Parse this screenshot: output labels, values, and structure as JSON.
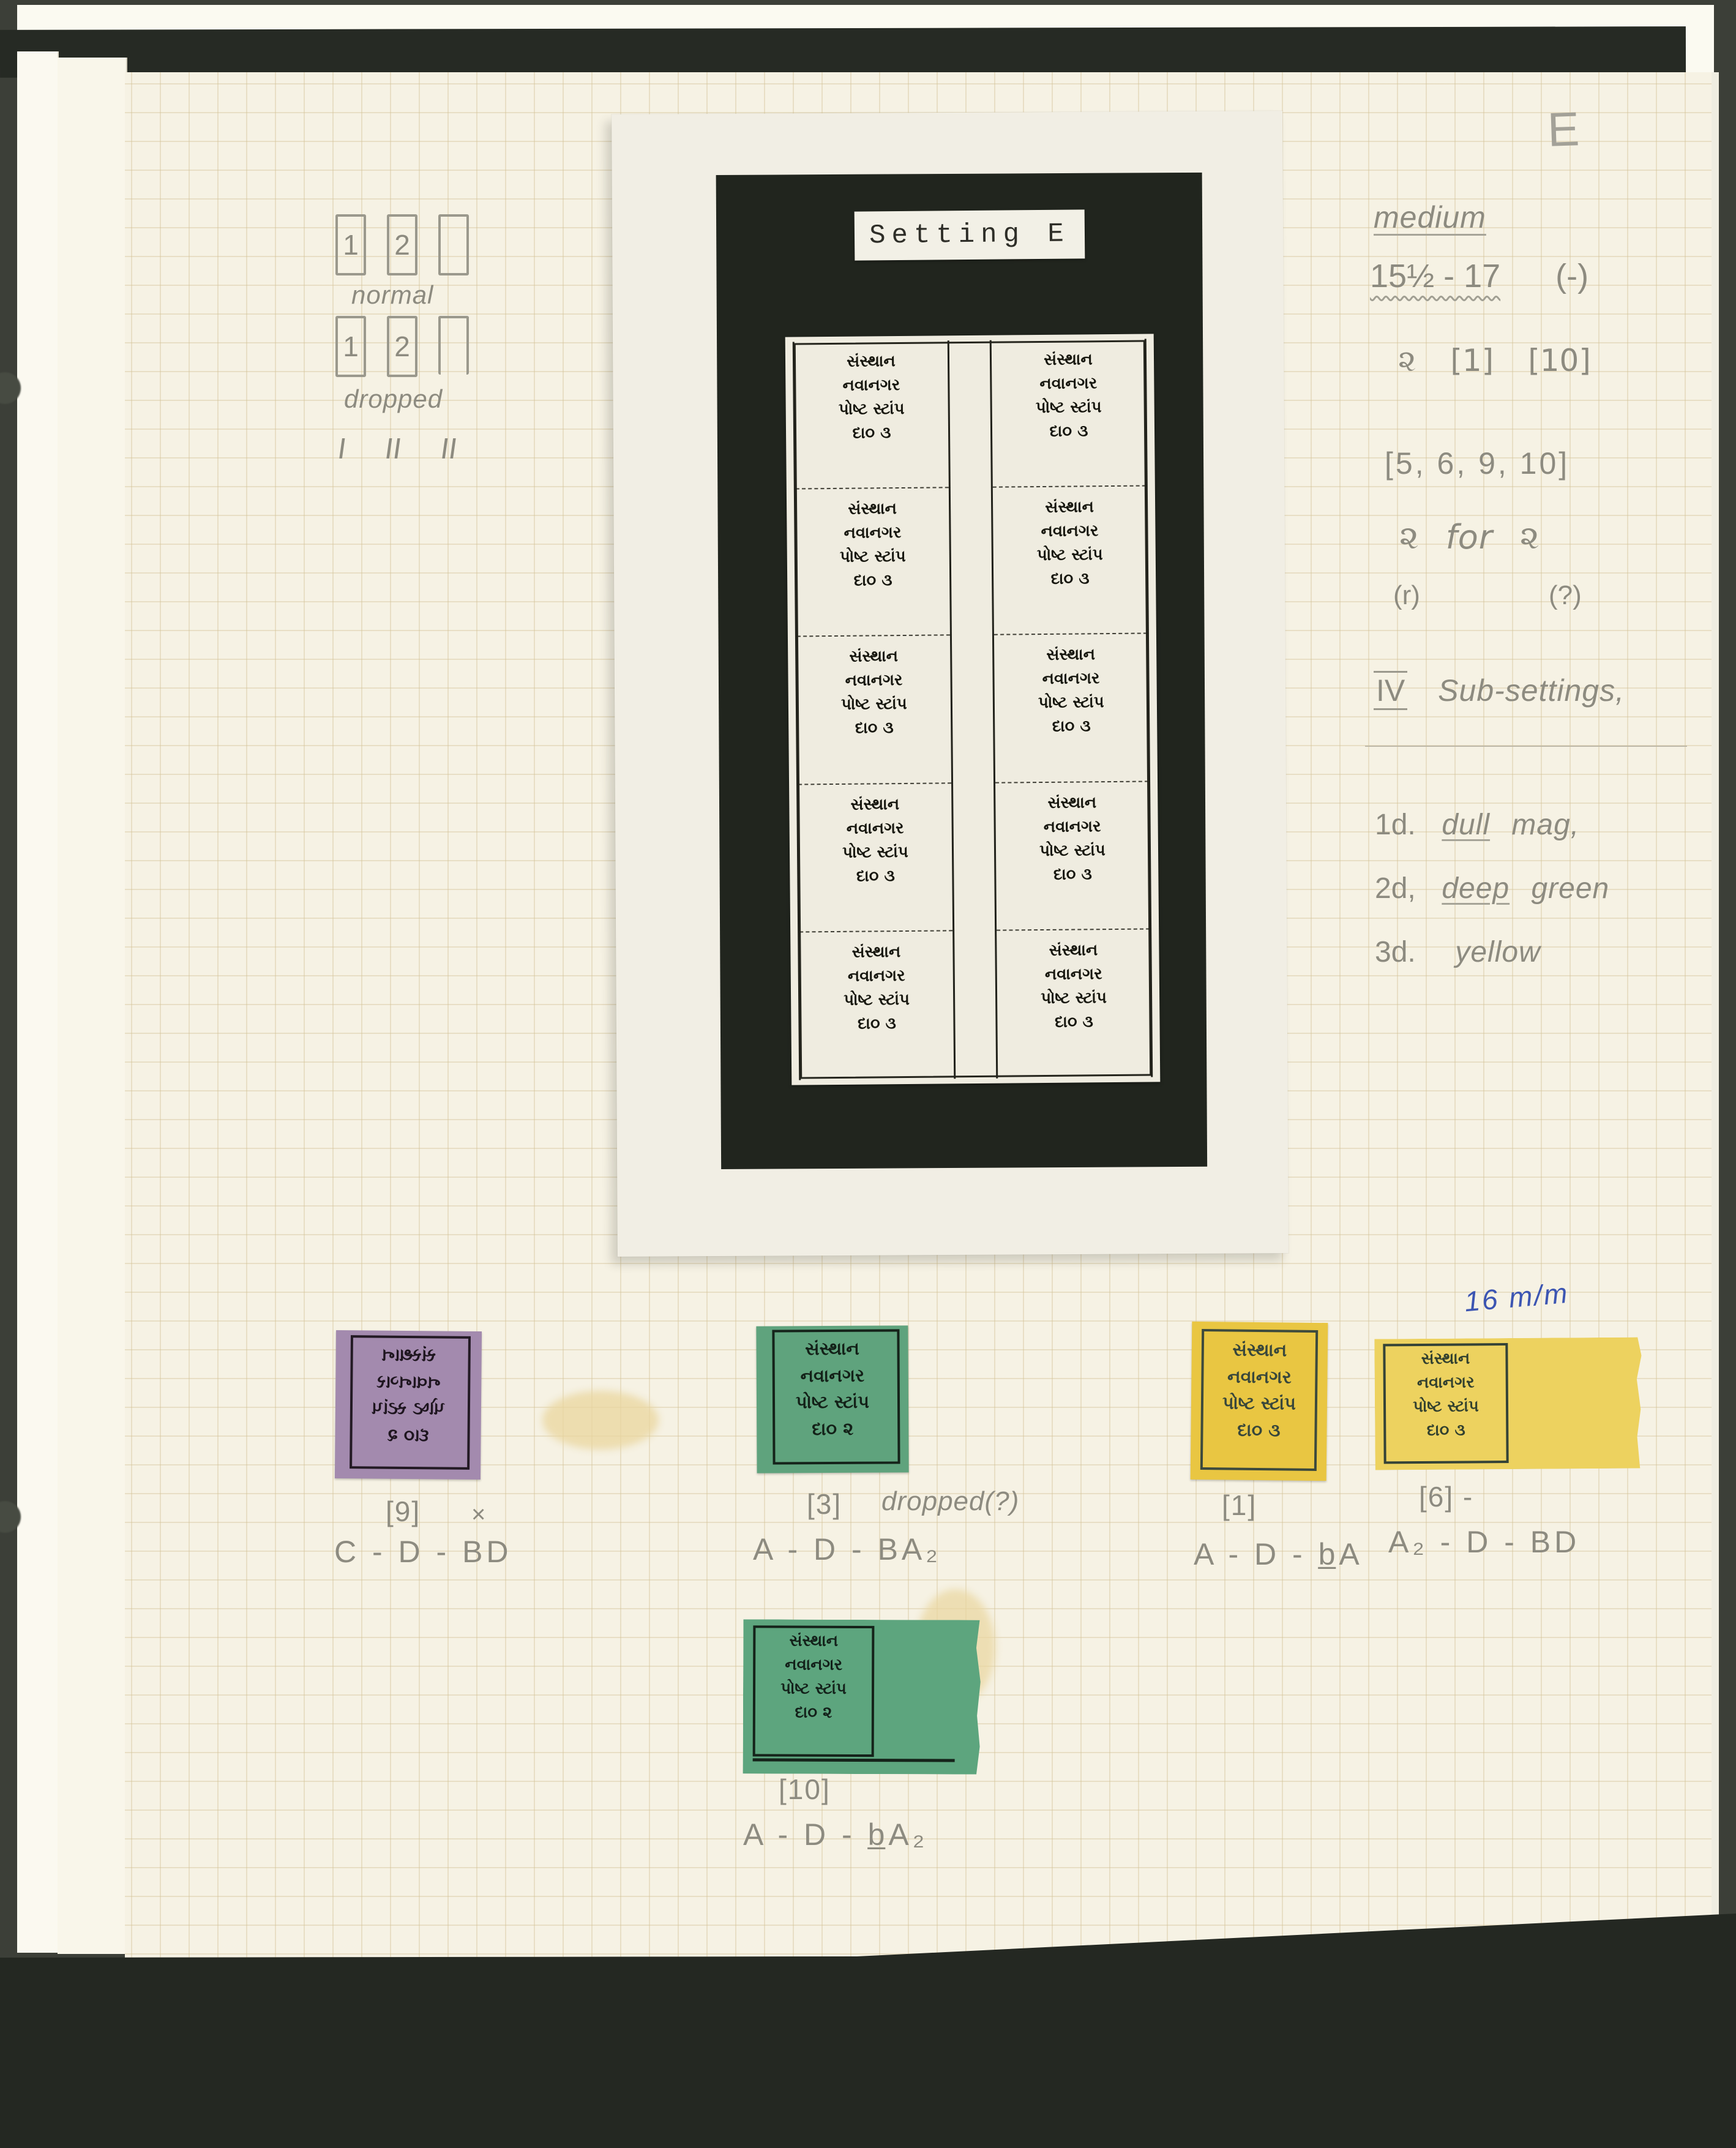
{
  "scan": {
    "corner_letter": "E"
  },
  "sketches": {
    "row1": {
      "cells": [
        "1",
        "2",
        ""
      ],
      "caption": "normal"
    },
    "row2": {
      "cells": [
        "1",
        "2",
        ""
      ],
      "caption": "dropped"
    },
    "tallies": [
      "I",
      "II",
      "II"
    ]
  },
  "photo": {
    "label": "Setting E",
    "stamp_lines": [
      "સંસ્થાન",
      "નવાનગર",
      "પોષ્ટ સ્ટાંપ",
      "દા૦  ૩"
    ]
  },
  "notes": {
    "medium": "medium",
    "gauge": "15½ - 17",
    "gauge_suffix": "(-)",
    "glyph": "૨",
    "ref_a": "[1]",
    "ref_b": "[10]",
    "positions": "[5, 6, 9, 10]",
    "swap_left": "૨",
    "swap_word": "for",
    "swap_right": "૨",
    "swap_sub_left": "(r)",
    "swap_sub_right": "(?)",
    "section_numeral": "IV",
    "section_title": "Sub-settings,",
    "items": [
      {
        "num": "1d.",
        "em": "dull",
        "rest": "mag,"
      },
      {
        "num": "2d,",
        "em": "deep",
        "rest": "green"
      },
      {
        "num": "3d.",
        "em": "",
        "rest": "yellow"
      }
    ]
  },
  "specimens": [
    {
      "color_name": "dull magenta",
      "lines": [
        "સંસ્થાન",
        "નવાનગર",
        "પોષ્ટ સ્ટાંપ",
        "દા૦  ૨"
      ],
      "caption": "[9]",
      "extra": "×",
      "formula": "C - D - BD"
    },
    {
      "color_name": "green",
      "lines": [
        "સંસ્થાન",
        "નવાનગર",
        "પોષ્ટ સ્ટાંપ",
        "દા૦  ૨"
      ],
      "caption": "[3]",
      "extra": "dropped(?)",
      "formula": "A - D - BA₂"
    },
    {
      "color_name": "yellow",
      "lines": [
        "સંસ્થાન",
        "નવાનગર",
        "પોષ્ટ સ્ટાંપ",
        "દા૦  ૩"
      ],
      "caption": "[1]",
      "extra": "",
      "formula": "A - D - b̲A"
    },
    {
      "color_name": "yellow",
      "lines": [
        "સંસ્થાન",
        "નવાનગર",
        "પોષ્ટ સ્ટાંપ",
        "દા૦  ૩"
      ],
      "caption": "[6] -",
      "extra": "",
      "formula": "A₂ - D - BD",
      "note_above": "16 m/m"
    },
    {
      "color_name": "green",
      "lines": [
        "સંસ્થાન",
        "નવાનગર",
        "પોષ્ટ સ્ટાંપ",
        "દા૦  ૨"
      ],
      "caption": "[10]",
      "extra": "",
      "formula": "A - D - b̲A₂"
    }
  ]
}
